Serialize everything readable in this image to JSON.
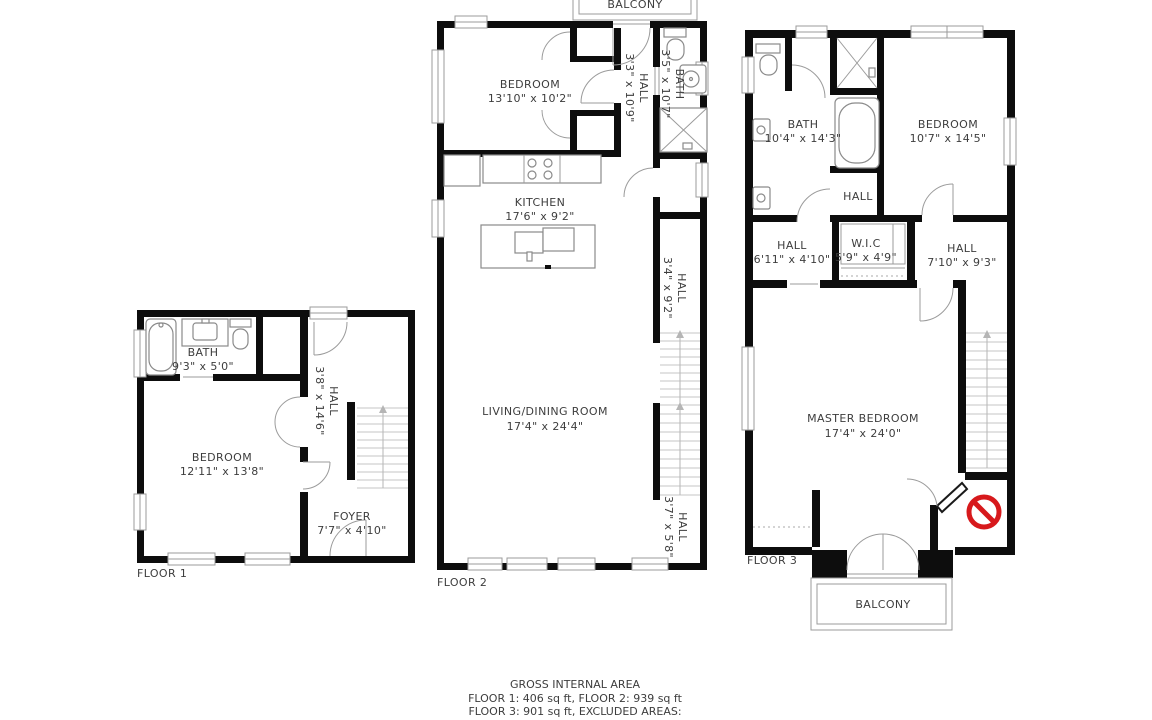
{
  "title": "3-floor apartment floor plan",
  "colors": {
    "wall": "#0d0d0d",
    "line": "#9b9b9b",
    "text": "#3d3d3d",
    "no_entry": "#d7191c",
    "background": "#ffffff"
  },
  "floors": [
    {
      "label": "FLOOR 1",
      "rooms": {
        "bath": {
          "name": "BATH",
          "dims": "9'3\" x 5'0\""
        },
        "bedroom": {
          "name": "BEDROOM",
          "dims": "12'11\" x 13'8\""
        },
        "hall": {
          "name": "HALL",
          "dims": "3'8\" x 14'6\""
        },
        "foyer": {
          "name": "FOYER",
          "dims": "7'7\" x 4'10\""
        }
      }
    },
    {
      "label": "FLOOR 2",
      "balcony_label": "BALCONY",
      "rooms": {
        "bedroom": {
          "name": "BEDROOM",
          "dims": "13'10\" x 10'2\""
        },
        "hall_a": {
          "name": "HALL",
          "dims": "3'3\" x 10'9\""
        },
        "bath": {
          "name": "BATH",
          "dims": "3'5\" x 10'7\""
        },
        "kitchen": {
          "name": "KITCHEN",
          "dims": "17'6\" x 9'2\""
        },
        "hall_b": {
          "name": "HALL",
          "dims": "3'4\" x 9'2\""
        },
        "living": {
          "name": "LIVING/DINING ROOM",
          "dims": "17'4\" x 24'4\""
        },
        "hall_c": {
          "name": "HALL",
          "dims": "3'7\" x 5'8\""
        }
      }
    },
    {
      "label": "FLOOR 3",
      "balcony_label": "BALCONY",
      "rooms": {
        "bath": {
          "name": "BATH",
          "dims": "10'4\" x 14'3\""
        },
        "bedroom": {
          "name": "BEDROOM",
          "dims": "10'7\" x 14'5\""
        },
        "hall_small": {
          "name": "HALL",
          "dims": ""
        },
        "hall_a": {
          "name": "HALL",
          "dims": "6'11\" x 4'10\""
        },
        "wic": {
          "name": "W.I.C",
          "dims": "5'9\" x 4'9\""
        },
        "hall_b": {
          "name": "HALL",
          "dims": "7'10\" x 9'3\""
        },
        "master": {
          "name": "MASTER BEDROOM",
          "dims": "17'4\" x 24'0\""
        }
      }
    }
  ],
  "footer": {
    "line1": "GROSS INTERNAL AREA",
    "line2": "FLOOR 1: 406 sq ft, FLOOR 2: 939 sq ft",
    "line3": "FLOOR 3: 901 sq ft, EXCLUDED AREAS:",
    "line4": "BALCONY: 65 sq ft, REDUCED HEADROOM BELOW 1.5M: 5 sq ft"
  }
}
